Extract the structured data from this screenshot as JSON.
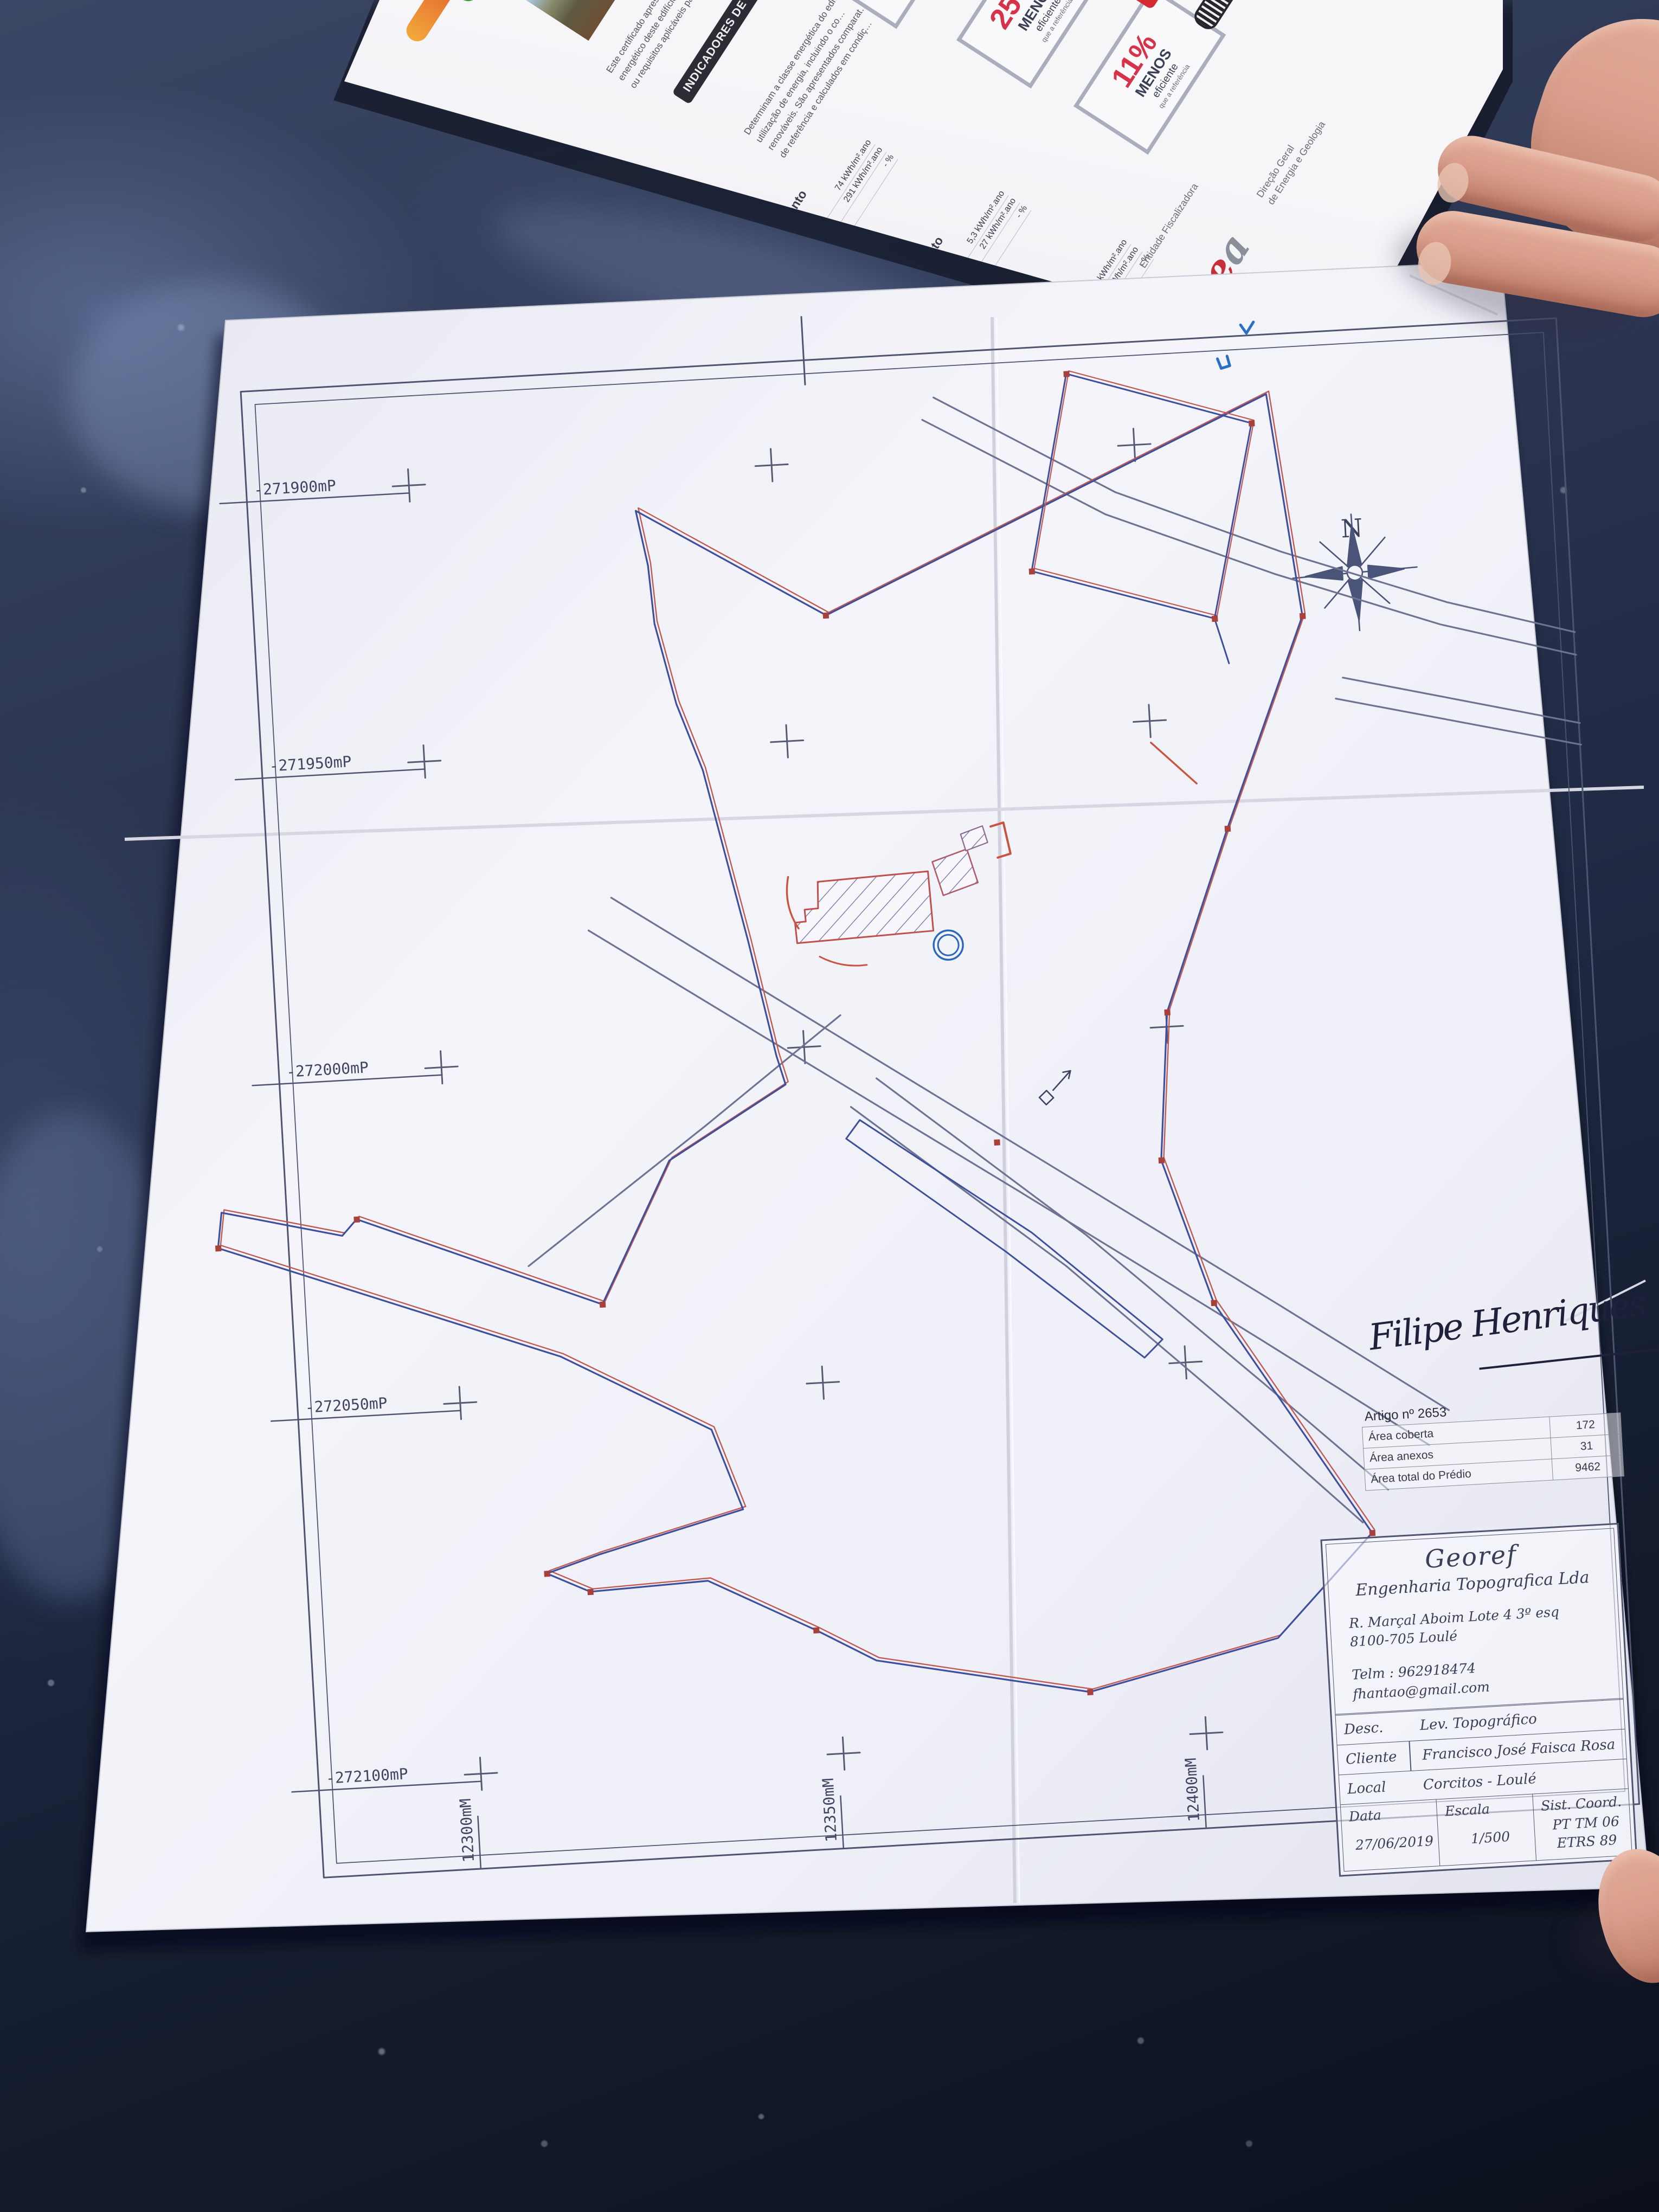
{
  "colors": {
    "boundary_blue": "#3f4f9c",
    "boundary_red": "#c05a55",
    "road_gray": "#6d7390",
    "paper": "#f2f2f8",
    "table_dark": "#232c42",
    "accent_red": "#d6324a"
  },
  "map": {
    "left_labels": [
      "-271900mP",
      "-271950mP",
      "-272000mP",
      "-272050mP",
      "-272100mP"
    ],
    "bottom_labels": [
      "12300mM",
      "12350mM",
      "12400mM"
    ],
    "north_label": "N",
    "signature_text": "Filipe Henriques",
    "artigo": {
      "title": "Artigo nº 2653",
      "rows": [
        {
          "label": "Área coberta",
          "value": "172"
        },
        {
          "label": "Área anexos",
          "value": "31"
        },
        {
          "label": "Área total do Prédio",
          "value": "9462"
        }
      ]
    },
    "titleblock": {
      "company": "Georef",
      "company_sub": "Engenharia Topografica Lda",
      "address1": "R. Marçal Aboim Lote 4 3º esq",
      "address2": "8100-705 Loulé",
      "phone": "Telm : 962918474",
      "email": "fhantao@gmail.com",
      "desc_label": "Desc.",
      "desc_value": "Lev. Topográfico",
      "cliente_label": "Cliente",
      "cliente_value": "Francisco José Faisca Rosa",
      "local_label": "Local",
      "local_value": "Corcitos - Loulé",
      "data_label": "Data",
      "data_value": "27/06/2019",
      "escala_label": "Escala",
      "escala_value": "1/500",
      "sist_label": "Sist. Coord.",
      "sist_value1": "PT TM 06",
      "sist_value2": "ETRS 89"
    }
  },
  "brochure": {
    "intro1": "Este certificado apresenta a cla…",
    "intro2": "energético deste edifício nas con…",
    "intro3": "ou requisitos aplicáveis para o a…",
    "banner": "INDICADORES DE DESEMPENHO",
    "det1": "Determinam a classe energética do edi…",
    "det2": "utilização de energia, incluindo o co…",
    "det3": "renováveis. São apresentados comparat…",
    "det4": "de referência e calculados em condiç…",
    "sections": [
      {
        "title1": "Aquecimento",
        "title2": "Ambiente",
        "icon_glyph": "✽",
        "ref_label": "Referência:",
        "ref_value": "74 kWh/m².ano",
        "ed_label": "Edifício:",
        "ed_value": "291 kWh/m².ano",
        "ren_label": "Renovável",
        "ren_value": "- %",
        "pct": "250%",
        "pct_l1": "MENOS",
        "pct_l2": "eficiente",
        "pct_l3": "que a referência"
      },
      {
        "title1": "Arrefecimento",
        "title2": "Ambiente",
        "icon_glyph": "✽",
        "ref_label": "Referência:",
        "ref_value": "5,3 kWh/m².ano",
        "ed_label": "Edifício:",
        "ed_value": "27 kWh/m².ano",
        "ren_label": "Renovável",
        "ren_value": "- %",
        "pct": "250%",
        "pct_l1": "MENOS",
        "pct_l2": "eficiente",
        "pct_l3": "que a referência"
      },
      {
        "title1": "Água Quente",
        "title2": "Sanitária",
        "icon_glyph": "::",
        "ref_label": "Referência:",
        "ref_value": "19 kWh/m².ano",
        "ed_label": "Edifício:",
        "ed_value": "21 kWh/m².ano",
        "ren_label": "Renovável",
        "ren_value": "- %",
        "pct": "11%",
        "pct_l1": "MENOS",
        "pct_l2": "eficiente",
        "pct_l3": "que a referência"
      }
    ],
    "entidade": "Entidade Fiscalizadora",
    "logo_e": "e",
    "logo_a": "a",
    "dgeg1": "Direção Geral",
    "dgeg2": "de Energia e Geologia"
  }
}
